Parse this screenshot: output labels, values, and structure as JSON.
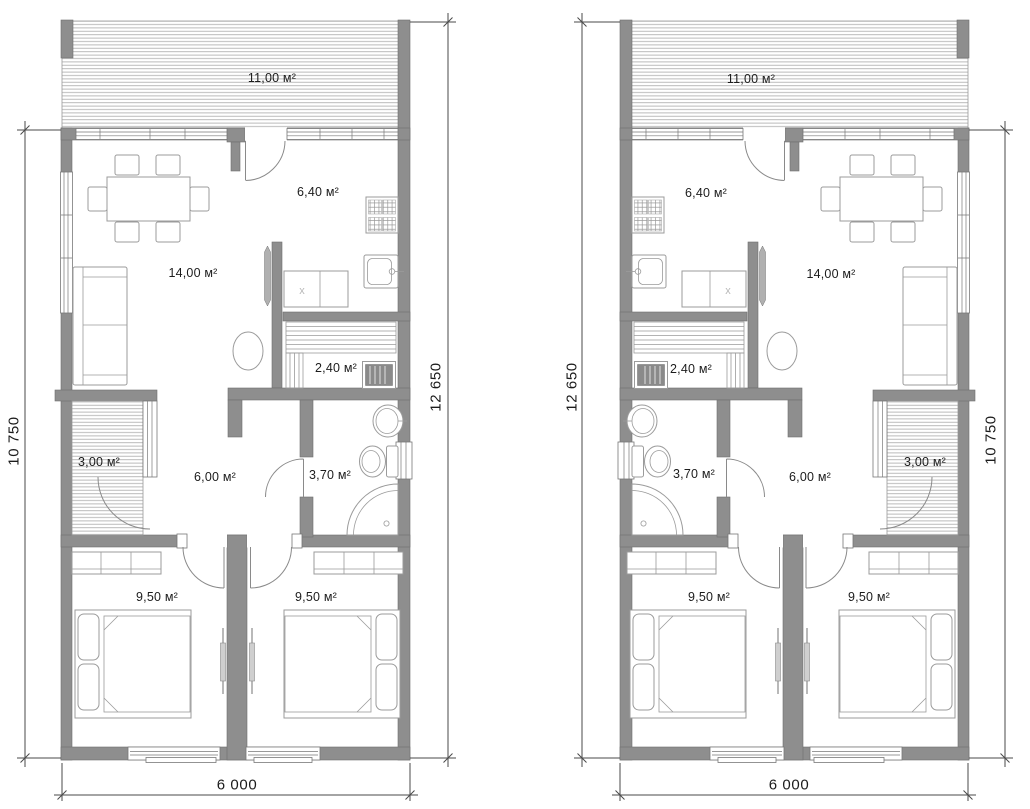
{
  "drawing": {
    "type": "architectural-floor-plan-two-mirrored-units",
    "wall_color": "#8e8e8e",
    "hatch_color": "#b3b3b3",
    "dimension_line_color": "#4a4a4a",
    "text_color": "#1c1c1c",
    "washer_mark": "x"
  },
  "plans": [
    {
      "id": "left-unit",
      "rooms": [
        {
          "id": "terrace",
          "area": "11,00 м²"
        },
        {
          "id": "kitchen",
          "area": "6,40 м²"
        },
        {
          "id": "living-room",
          "area": "14,00 м²"
        },
        {
          "id": "sauna",
          "area": "2,40 м²"
        },
        {
          "id": "porch",
          "area": "3,00 м²"
        },
        {
          "id": "hall",
          "area": "6,00 м²"
        },
        {
          "id": "bathroom",
          "area": "3,70 м²"
        },
        {
          "id": "bedroom-1",
          "area": "9,50 м²"
        },
        {
          "id": "bedroom-2",
          "area": "9,50 м²"
        }
      ],
      "dimensions": {
        "left": "10 750",
        "right": "12 650",
        "bottom": "6 000"
      }
    },
    {
      "id": "right-unit",
      "rooms": [
        {
          "id": "terrace",
          "area": "11,00 м²"
        },
        {
          "id": "kitchen",
          "area": "6,40 м²"
        },
        {
          "id": "living-room",
          "area": "14,00 м²"
        },
        {
          "id": "sauna",
          "area": "2,40 м²"
        },
        {
          "id": "porch",
          "area": "3,00 м²"
        },
        {
          "id": "hall",
          "area": "6,00 м²"
        },
        {
          "id": "bathroom",
          "area": "3,70 м²"
        },
        {
          "id": "bedroom-1",
          "area": "9,50 м²"
        },
        {
          "id": "bedroom-2",
          "area": "9,50 м²"
        }
      ],
      "dimensions": {
        "left": "12 650",
        "right": "10 750",
        "bottom": "6 000"
      }
    }
  ]
}
